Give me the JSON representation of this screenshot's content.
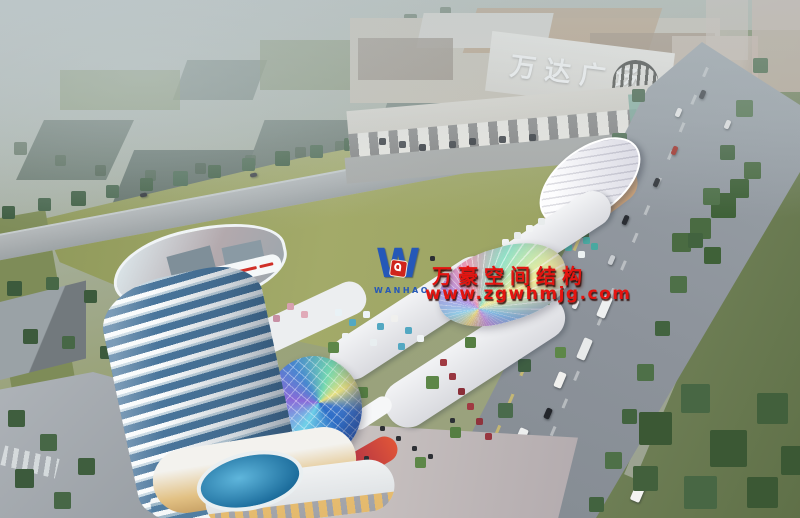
{
  "signs": {
    "mall_banner": "万达广场"
  },
  "watermark": {
    "logo_letter": "W",
    "logo_name": "WANHAO",
    "brand": "万豪空间结构",
    "website": "www.zgwhmjg.com",
    "text_color": "#e41410",
    "logo_blue": "#2558b8",
    "logo_red": "#cf241c"
  },
  "palette": {
    "haze": "#b6bfbf",
    "field_green": "#97a05f",
    "grass_dark": "#5f7048",
    "road_gray": "#8d939b",
    "mall_beige": "#c6bfb0",
    "tower_glass_blue": "#4a769c",
    "dome_blue": "#2f6fc8",
    "canopy_rainbow": [
      "#f2e27c",
      "#9adcf2",
      "#b293e2",
      "#ef9cb4",
      "#92e2c8"
    ],
    "pool_blue": "#1e6f9e",
    "lane_yellow": "#d8c468"
  }
}
